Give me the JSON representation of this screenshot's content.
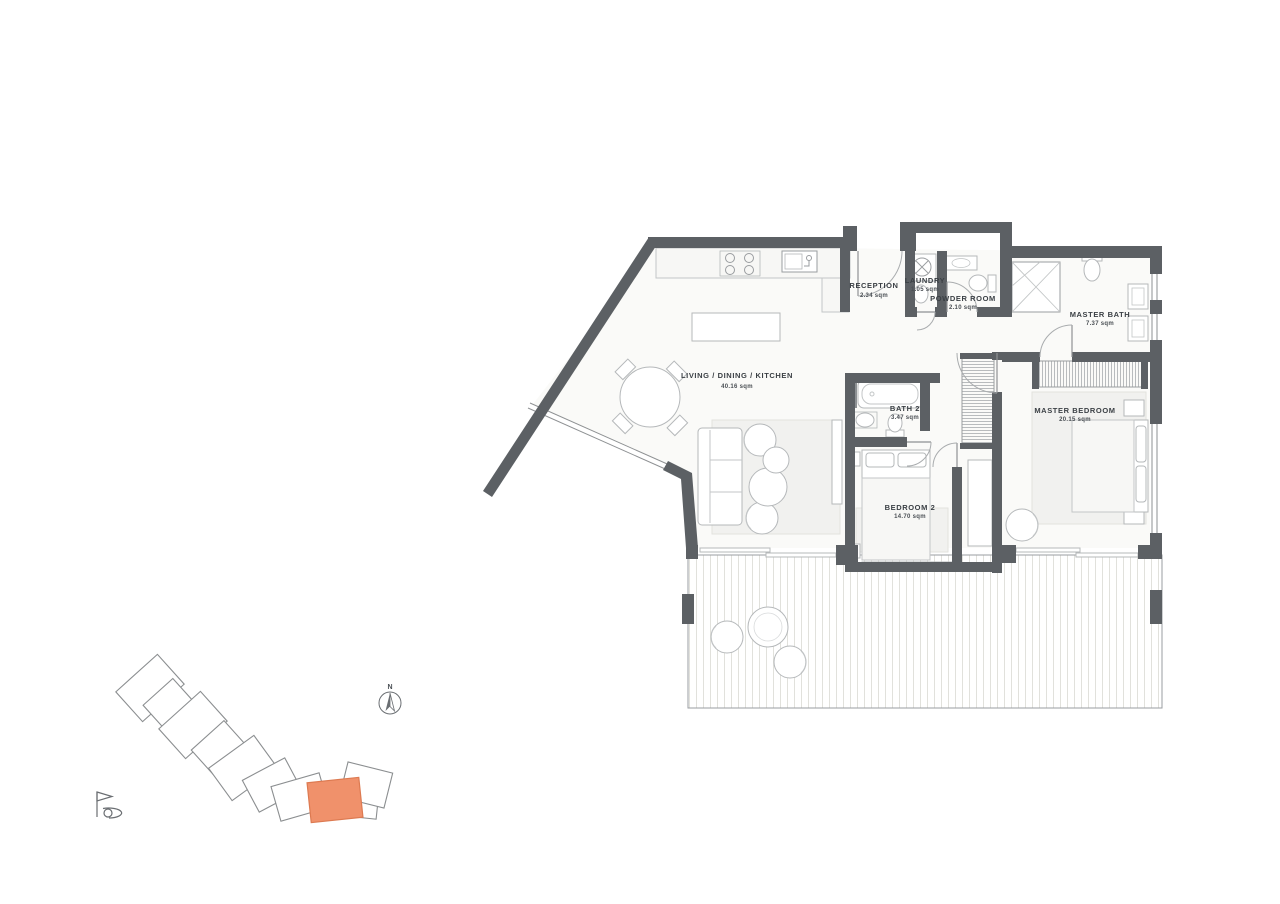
{
  "floor_plan": {
    "rooms": [
      {
        "name": "LIVING / DINING / KITCHEN",
        "area": "40.16 sqm"
      },
      {
        "name": "RECEPTION",
        "area": "2.34 sqm"
      },
      {
        "name": "LAUNDRY",
        "area": "1.05 sqm"
      },
      {
        "name": "POWDER ROOM",
        "area": "2.10 sqm"
      },
      {
        "name": "MASTER BATH",
        "area": "7.37 sqm"
      },
      {
        "name": "BATH 2",
        "area": "3.47 sqm"
      },
      {
        "name": "MASTER BEDROOM",
        "area": "20.15 sqm"
      },
      {
        "name": "BEDROOM 2",
        "area": "14.70 sqm"
      }
    ],
    "compass": {
      "label": "N"
    },
    "colors": {
      "wall": "#5c6064",
      "floor": "#fafaf8",
      "highlight": "#f0916b",
      "highlight_border": "#dd7a51",
      "label_text": "#3b4045"
    },
    "icons": [
      "north-compass-icon",
      "golf-flag-icon"
    ]
  },
  "site_plan": {
    "highlighted_unit_color": "#f0916b",
    "unit_outline_color": "#8b8e90"
  }
}
